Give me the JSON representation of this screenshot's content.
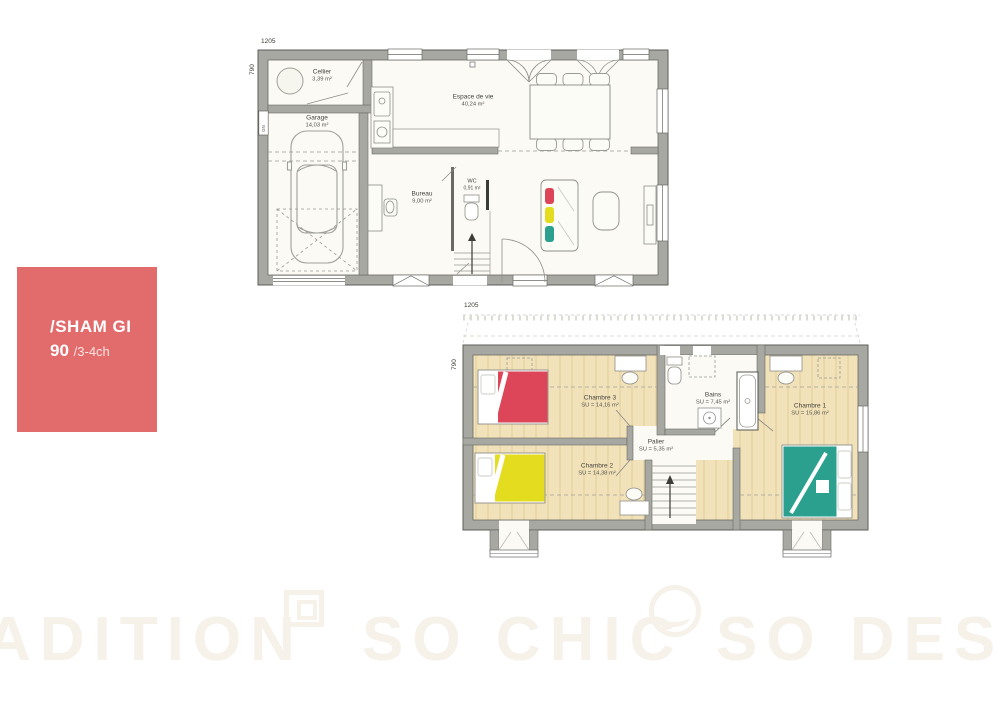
{
  "brand_card": {
    "title": "/SHAM GI",
    "model": "90",
    "variant": "/3-4ch",
    "bg_color": "#e26b6b"
  },
  "ground_floor": {
    "width_dim": "1205",
    "height_dim": "790",
    "wall_tag": "GN",
    "rooms": {
      "cellier": {
        "name": "Cellier",
        "area": "3,39 m²"
      },
      "garage": {
        "name": "Garage",
        "area": "14,03 m²"
      },
      "espace": {
        "name": "Espace de vie",
        "area": "40,24 m²"
      },
      "bureau": {
        "name": "Bureau",
        "area": "9,00 m²"
      },
      "wc": {
        "name": "WC",
        "area": "0,91 m²"
      }
    }
  },
  "upper_floor": {
    "width_dim": "1205",
    "height_dim": "790",
    "rooms": {
      "chambre3": {
        "name": "Chambre 3",
        "area": "SU = 14,16 m²"
      },
      "bains": {
        "name": "Bains",
        "area": "SU = 7,45 m²"
      },
      "chambre1": {
        "name": "Chambre 1",
        "area": "SU = 15,86 m²"
      },
      "palier": {
        "name": "Palier",
        "area": "SU = 5,35 m²"
      },
      "chambre2": {
        "name": "Chambre 2",
        "area": "SU = 14,38 m²"
      }
    }
  },
  "watermark": {
    "left": "ADITION",
    "center": "SO CHIC",
    "right": "SO DESI"
  },
  "colors": {
    "wall": "#a8a8a2",
    "floor_wood": "#f2e2ba",
    "accent_red": "#dd4659",
    "accent_yellow": "#e4dd1f",
    "accent_teal": "#2ba08f",
    "brand": "#e26b6b",
    "watermark": "#f6f1e9"
  }
}
